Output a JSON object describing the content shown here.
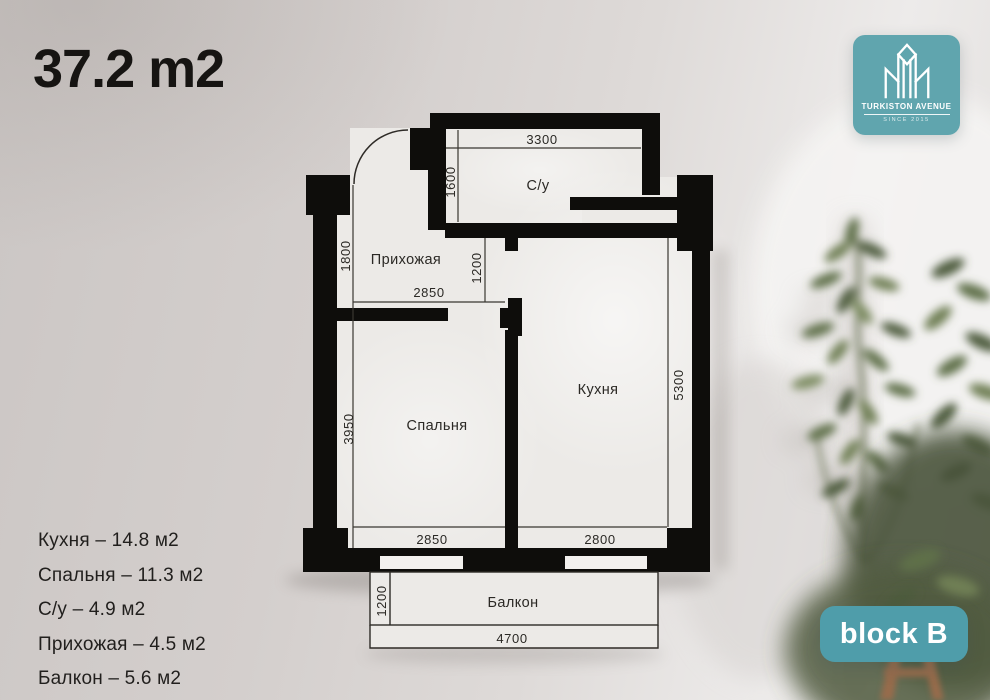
{
  "title": "37.2 m2",
  "logo": {
    "brand": "TURKISTON AVENUE",
    "tagline": "SINCE 2015",
    "accent_color": "#60a5ae"
  },
  "badge": {
    "label": "block B",
    "accent_color": "#4f9daa"
  },
  "area_list": {
    "items": [
      "Кухня – 14.8 м2",
      "Спальня – 11.3 м2",
      "С/у – 4.9 м2",
      "Прихожая – 4.5 м2",
      "Балкон – 5.6 м2"
    ]
  },
  "plan": {
    "wall_color": "#0e0d0b",
    "rooms": [
      {
        "label": "С/у"
      },
      {
        "label": "Прихожая"
      },
      {
        "label": "Спальня"
      },
      {
        "label": "Кухня"
      },
      {
        "label": "Балкон"
      }
    ],
    "dims": [
      {
        "value": "3300"
      },
      {
        "value": "1600"
      },
      {
        "value": "1800"
      },
      {
        "value": "1200"
      },
      {
        "value": "2850"
      },
      {
        "value": "3950"
      },
      {
        "value": "2850"
      },
      {
        "value": "2800"
      },
      {
        "value": "5300"
      },
      {
        "value": "1200"
      },
      {
        "value": "4700"
      }
    ]
  }
}
